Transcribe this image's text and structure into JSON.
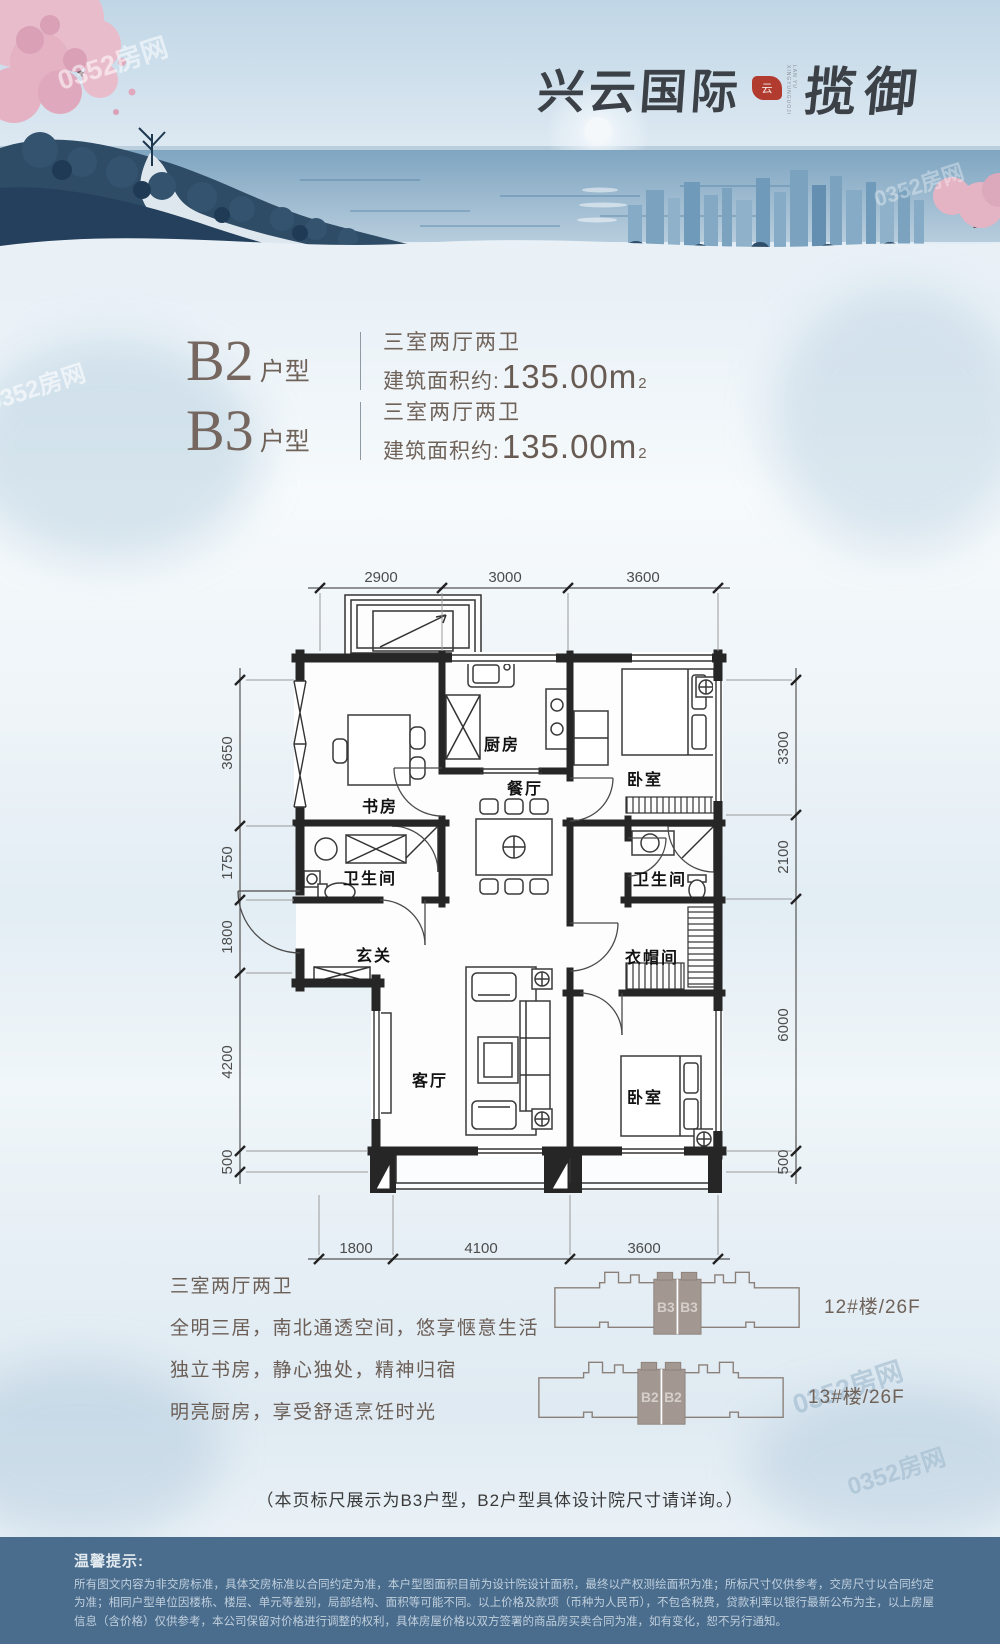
{
  "watermark": "0352房网",
  "header": {
    "logo_main": "兴云国际",
    "logo_sub": "揽御",
    "logo_seal_glyph": "云",
    "logo_caption": "LAN YU XINGYUNGUOJI"
  },
  "units": [
    {
      "code": "B2",
      "suffix": "户型",
      "layout": "三室两厅两卫",
      "area_label": "建筑面积约:",
      "area_value": "135.00m",
      "area_sup": "2"
    },
    {
      "code": "B3",
      "suffix": "户型",
      "layout": "三室两厅两卫",
      "area_label": "建筑面积约:",
      "area_value": "135.00m",
      "area_sup": "2"
    }
  ],
  "floor_plan": {
    "dims_top": [
      "2900",
      "3000",
      "3600"
    ],
    "dims_left": [
      "3650",
      "1750",
      "1800",
      "4200",
      "500"
    ],
    "dims_right": [
      "3300",
      "2100",
      "6000",
      "500"
    ],
    "dims_bottom": [
      "1800",
      "4100",
      "3600"
    ],
    "rooms": {
      "study": "书房",
      "kitchen": "厨房",
      "dining": "餐厅",
      "bedroom_top": "卧室",
      "bath_left": "卫生间",
      "entry": "玄关",
      "bath_right": "卫生间",
      "cloakroom": "衣帽间",
      "living": "客厅",
      "bedroom_bottom": "卧室"
    }
  },
  "description": {
    "title": "三室两厅两卫",
    "lines": [
      "全明三居，南北通透空间，悠享惬意生活",
      "独立书房，静心独处，精神归宿",
      "明亮厨房，享受舒适烹饪时光"
    ]
  },
  "buildings": [
    {
      "units": [
        "B3",
        "B3"
      ],
      "label": "12#楼/26F"
    },
    {
      "units": [
        "B2",
        "B2"
      ],
      "label": "13#楼/26F"
    }
  ],
  "note": "（本页标尺展示为B3户型，B2户型具体设计院尺寸请详询。）",
  "footer": {
    "title": "温馨提示:",
    "text": "所有图文内容为非交房标准，具体交房标准以合同约定为准，本户型图面积目前为设计院设计面积，最终以产权测绘面积为准；所标尺寸仅供参考，交房尺寸以合同约定为准；相同户型单位因楼栋、楼层、单元等差别，局部结构、面积等可能不同。以上价格及款项（币种为人民币），不包含税费，贷款利率以银行最新公布为主，以上房屋信息（含价格）仅供参考，本公司保留对价格进行调整的权利，具体房屋价格以双方签署的商品房买卖合同为准，如有变化，恕不另行通知。"
  },
  "colors": {
    "accent_brown": "#6f6259",
    "seal_red": "#b23b30",
    "footer_bg": "#4a6d8e",
    "plan_ink": "#262626",
    "building_gray": "#a29791"
  }
}
